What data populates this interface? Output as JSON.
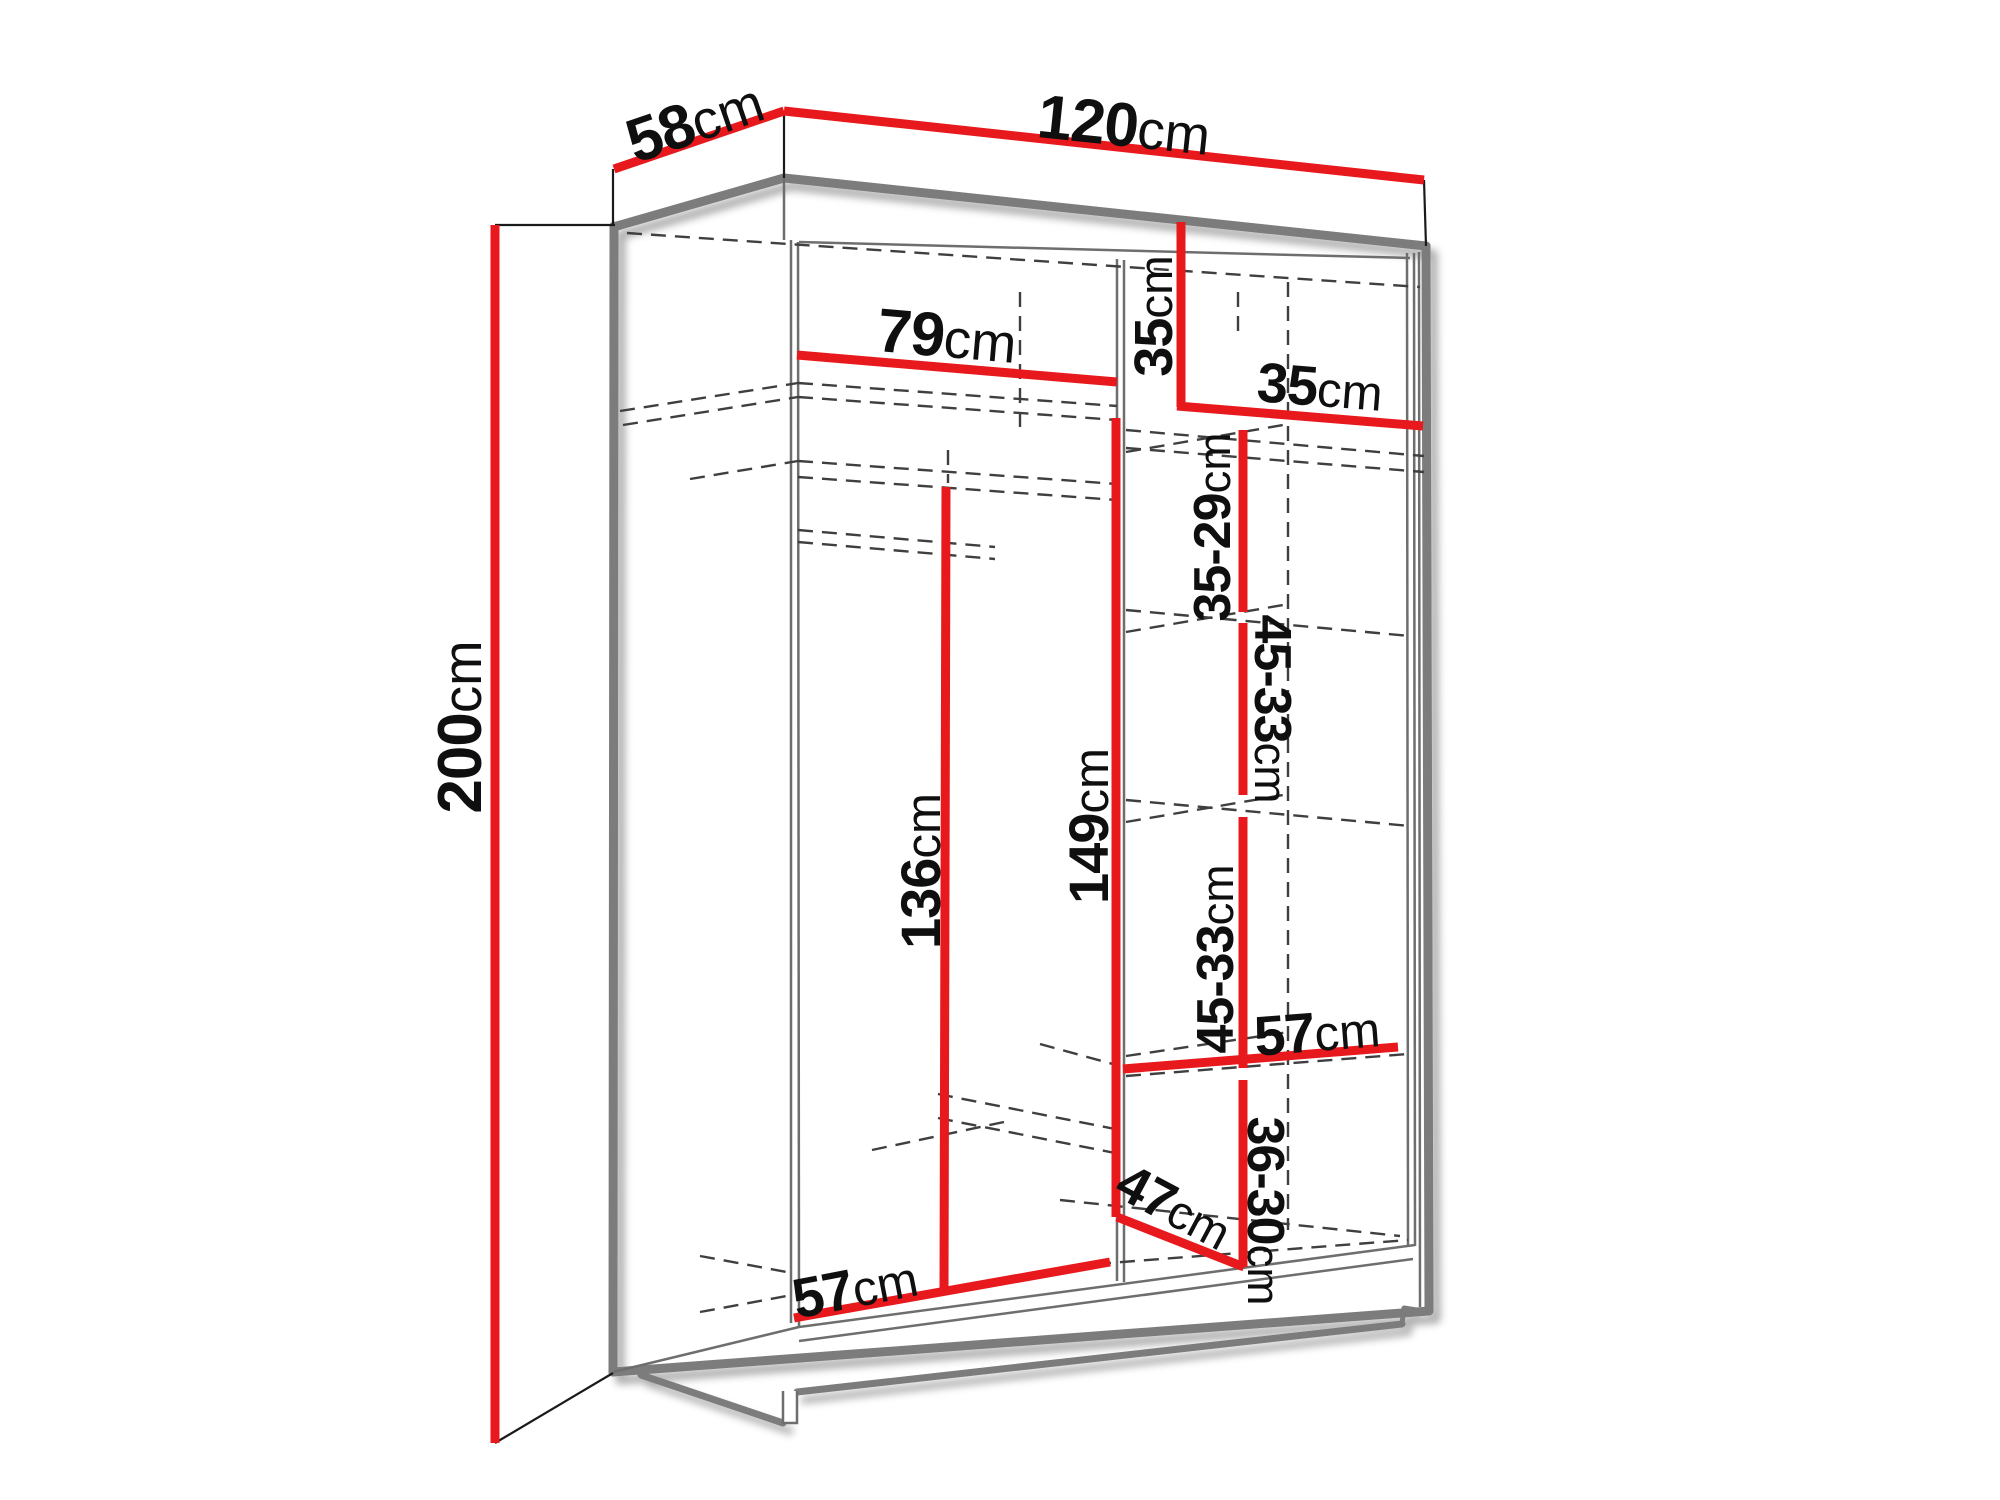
{
  "diagram": {
    "title": "wardrobe-interior-dimensions",
    "unit": "cm",
    "colors": {
      "dimension_line": "#e8191d",
      "structure_line": "#7b7b7b",
      "hidden_line": "#3f3f3f",
      "connector_line": "#1a1a1a",
      "text": "#0f0f0f",
      "background": "#ffffff"
    },
    "dimensions": [
      {
        "id": "d120",
        "value": "120",
        "unit": "cm"
      },
      {
        "id": "d58",
        "value": "58",
        "unit": "cm"
      },
      {
        "id": "d200",
        "value": "200",
        "unit": "cm"
      },
      {
        "id": "d79",
        "value": "79",
        "unit": "cm"
      },
      {
        "id": "d35v",
        "value": "35",
        "unit": "cm"
      },
      {
        "id": "d35h",
        "value": "35",
        "unit": "cm"
      },
      {
        "id": "d3529",
        "value": "35-29",
        "unit": "cm"
      },
      {
        "id": "d4533a",
        "value": "45-33",
        "unit": "cm"
      },
      {
        "id": "d4533b",
        "value": "45-33",
        "unit": "cm"
      },
      {
        "id": "d149",
        "value": "149",
        "unit": "cm"
      },
      {
        "id": "d136",
        "value": "136",
        "unit": "cm"
      },
      {
        "id": "d57mid",
        "value": "57",
        "unit": "cm"
      },
      {
        "id": "d3630",
        "value": "36-30",
        "unit": "cm"
      },
      {
        "id": "d47",
        "value": "47",
        "unit": "cm"
      },
      {
        "id": "d57bot",
        "value": "57",
        "unit": "cm"
      }
    ]
  }
}
